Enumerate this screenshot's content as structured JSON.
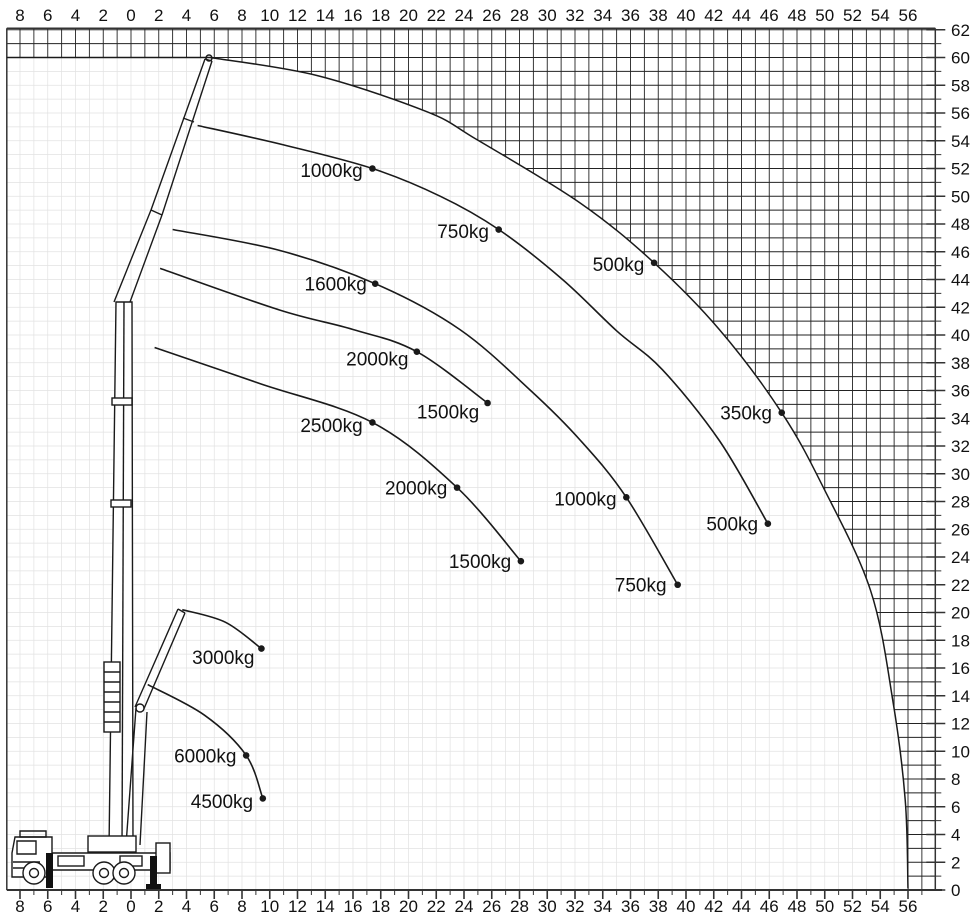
{
  "meta": {
    "kind": "crane load capacity working range diagram"
  },
  "layout_hints": {
    "origin_px": {
      "x": 131,
      "y": 890
    },
    "unit_px": 13.875,
    "plot_px": {
      "left": 6.8,
      "right": 935.3,
      "top": 28.3,
      "bottom": 890
    },
    "bottom_axis_end_px": 942,
    "grid_step_m": 1,
    "colors": {
      "hatch": "#222222",
      "fine_grid": "#e2e2e2",
      "curve": "#1a1a1a",
      "frame": "#333333",
      "text": "#111111"
    }
  },
  "axes": {
    "top_labels": [
      "8",
      "6",
      "4",
      "2",
      "0",
      "2",
      "4",
      "6",
      "8",
      "10",
      "12",
      "14",
      "16",
      "18",
      "20",
      "22",
      "24",
      "26",
      "28",
      "30",
      "32",
      "34",
      "36",
      "38",
      "40",
      "42",
      "44",
      "46",
      "48",
      "50",
      "52",
      "54",
      "56"
    ],
    "bottom_labels": [
      "8",
      "6",
      "4",
      "2",
      "0",
      "2",
      "4",
      "6",
      "8",
      "10",
      "12",
      "14",
      "16",
      "18",
      "20",
      "22",
      "24",
      "26",
      "28",
      "30",
      "32",
      "34",
      "36",
      "38",
      "40",
      "42",
      "44",
      "46",
      "48",
      "50",
      "52",
      "54",
      "56"
    ],
    "right_labels": [
      "62",
      "60",
      "58",
      "56",
      "54",
      "52",
      "50",
      "48",
      "46",
      "44",
      "42",
      "40",
      "38",
      "36",
      "34",
      "32",
      "30",
      "28",
      "26",
      "24",
      "22",
      "20",
      "18",
      "16",
      "14",
      "12",
      "10",
      "8",
      "6",
      "4",
      "2",
      "0"
    ],
    "top_start_value": -8,
    "top_step": 2,
    "right_start_value": 62,
    "right_step": -2
  },
  "chart_data": {
    "type": "line",
    "title": "",
    "xlabel": "",
    "ylabel": "",
    "x_range_m": [
      -9,
      58
    ],
    "y_range_m": [
      0,
      62
    ],
    "grid": "on",
    "forbidden_region": "crosshatched outside working envelope",
    "envelope": {
      "name": "max-working-envelope",
      "points": [
        [
          5.7,
          60.0
        ],
        [
          13.4,
          58.7
        ],
        [
          21.3,
          56.1
        ],
        [
          24.9,
          54.1
        ],
        [
          32.4,
          49.5
        ],
        [
          37.7,
          45.2
        ],
        [
          42.4,
          40.4
        ],
        [
          46.9,
          34.4
        ],
        [
          49.9,
          29.0
        ],
        [
          53.3,
          21.6
        ],
        [
          54.9,
          13.7
        ],
        [
          55.8,
          6.5
        ],
        [
          56.0,
          0.1
        ]
      ],
      "dots": [
        {
          "label": "500kg",
          "at": [
            37.7,
            45.2
          ],
          "label_at": [
            37.0,
            44.6
          ]
        },
        {
          "label": "350kg",
          "at": [
            46.9,
            34.4
          ],
          "label_at": [
            46.2,
            33.9
          ]
        }
      ]
    },
    "capacity_arcs": [
      {
        "name": "arc-jib-long",
        "points": [
          [
            4.8,
            55.1
          ],
          [
            11.0,
            53.7
          ],
          [
            17.4,
            52.0
          ],
          [
            22.3,
            50.0
          ],
          [
            26.5,
            47.6
          ],
          [
            31.1,
            44.0
          ],
          [
            35.0,
            40.3
          ],
          [
            38.3,
            37.5
          ],
          [
            42.4,
            32.4
          ],
          [
            45.9,
            26.4
          ]
        ],
        "dots": [
          {
            "label": "1000kg",
            "at": [
              17.4,
              52.0
            ],
            "label_at": [
              16.7,
              51.4
            ]
          },
          {
            "label": "750kg",
            "at": [
              26.5,
              47.6
            ],
            "label_at": [
              25.8,
              47.0
            ]
          },
          {
            "label": "500kg",
            "at": [
              45.9,
              26.4
            ],
            "label_at": [
              45.2,
              25.9
            ]
          }
        ]
      },
      {
        "name": "arc-jib-mid",
        "points": [
          [
            3.0,
            47.6
          ],
          [
            10.7,
            46.1
          ],
          [
            17.6,
            43.7
          ],
          [
            23.7,
            40.4
          ],
          [
            28.8,
            36.0
          ],
          [
            32.4,
            32.4
          ],
          [
            35.7,
            28.3
          ],
          [
            39.4,
            22.0
          ]
        ],
        "dots": [
          {
            "label": "1600kg",
            "at": [
              17.6,
              43.7
            ],
            "label_at": [
              17.0,
              43.2
            ]
          },
          {
            "label": "1000kg",
            "at": [
              35.7,
              28.3
            ],
            "label_at": [
              35.0,
              27.7
            ]
          },
          {
            "label": "750kg",
            "at": [
              39.4,
              22.0
            ],
            "label_at": [
              38.6,
              21.5
            ]
          }
        ]
      },
      {
        "name": "arc-boom-ext-1",
        "points": [
          [
            2.1,
            44.8
          ],
          [
            10.7,
            41.8
          ],
          [
            16.0,
            40.4
          ],
          [
            20.6,
            38.8
          ],
          [
            25.7,
            35.1
          ]
        ],
        "dots": [
          {
            "label": "2000kg",
            "at": [
              20.6,
              38.8
            ],
            "label_at": [
              20.0,
              37.8
            ]
          },
          {
            "label": "1500kg",
            "at": [
              25.7,
              35.1
            ],
            "label_at": [
              25.1,
              34.0
            ]
          }
        ]
      },
      {
        "name": "arc-boom-ext-2",
        "points": [
          [
            1.7,
            39.1
          ],
          [
            9.3,
            36.5
          ],
          [
            17.4,
            33.7
          ],
          [
            23.5,
            29.0
          ],
          [
            28.1,
            23.7
          ]
        ],
        "dots": [
          {
            "label": "2500kg",
            "at": [
              17.4,
              33.7
            ],
            "label_at": [
              16.7,
              33.0
            ]
          },
          {
            "label": "2000kg",
            "at": [
              23.5,
              29.0
            ],
            "label_at": [
              22.8,
              28.5
            ]
          },
          {
            "label": "1500kg",
            "at": [
              28.1,
              23.7
            ],
            "label_at": [
              27.4,
              23.2
            ]
          }
        ]
      },
      {
        "name": "arc-short-jib",
        "points": [
          [
            3.7,
            20.2
          ],
          [
            6.8,
            19.3
          ],
          [
            9.4,
            17.4
          ]
        ],
        "dots": [
          {
            "label": "3000kg",
            "at": [
              9.4,
              17.4
            ],
            "label_at": [
              8.9,
              16.3
            ]
          }
        ]
      },
      {
        "name": "arc-main-boom-low",
        "points": [
          [
            1.2,
            14.8
          ],
          [
            5.3,
            12.6
          ],
          [
            8.3,
            9.7
          ],
          [
            9.5,
            6.6
          ]
        ],
        "dots": [
          {
            "label": "6000kg",
            "at": [
              8.3,
              9.7
            ],
            "label_at": [
              7.6,
              9.2
            ]
          },
          {
            "label": "4500kg",
            "at": [
              9.5,
              6.6
            ],
            "label_at": [
              8.8,
              5.9
            ]
          }
        ]
      }
    ]
  }
}
